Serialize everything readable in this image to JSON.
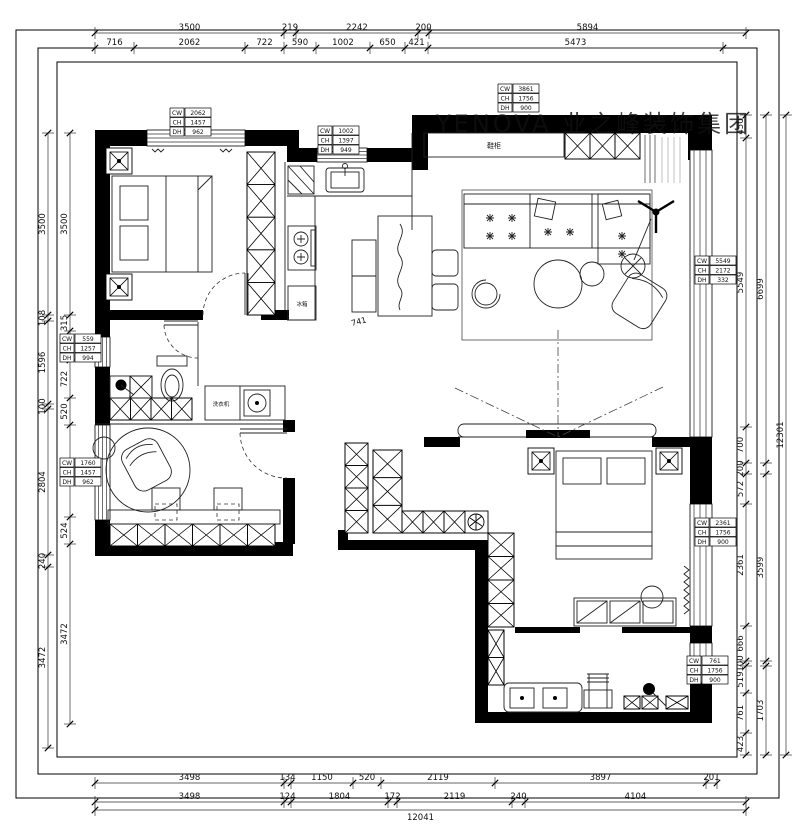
{
  "watermark": "YENOVA 业之峰装饰集团",
  "labels": {
    "entry_cabinet": "鞋柜",
    "washer": "洗衣机",
    "kitchen_appliance": "冰箱",
    "interior_dim": "741"
  },
  "dimensions": {
    "top_outer": [
      "3500",
      "219",
      "2242",
      "200",
      "5894"
    ],
    "top_inner": [
      "716",
      "2062",
      "722",
      "590",
      "1002",
      "650",
      "421",
      "5473"
    ],
    "bottom_inner": [
      "3498",
      "134",
      "1150",
      "520",
      "2119",
      "3897",
      "201"
    ],
    "bottom_outer": [
      "3498",
      "124",
      "1804",
      "172",
      "2119",
      "240",
      "4104"
    ],
    "bottom_total": [
      "12041"
    ],
    "left_outer": [
      "3500",
      "108",
      "1596",
      "100",
      "2804",
      "240",
      "3472"
    ],
    "left_inner": [
      "3500",
      "315",
      "559",
      "722",
      "520",
      "1760",
      "524",
      "3472"
    ],
    "right_inner": [
      "450",
      "5549",
      "700",
      "200",
      "572",
      "2361",
      "666",
      "100",
      "519",
      "761",
      "423"
    ],
    "right_mid": [
      "6699",
      "",
      "3599",
      "",
      "1703"
    ],
    "right_total": [
      "12301"
    ]
  },
  "window_tags": {
    "field_labels": [
      "CW",
      "CH",
      "DH"
    ],
    "tags": [
      {
        "name": "bedroom-window",
        "cw": "2062",
        "ch": "1457",
        "dh": "962"
      },
      {
        "name": "kitchen-window",
        "cw": "1002",
        "ch": "1397",
        "dh": "949"
      },
      {
        "name": "entry-window",
        "cw": "3861",
        "ch": "1756",
        "dh": "900"
      },
      {
        "name": "left-small-window",
        "cw": "559",
        "ch": "1257",
        "dh": "994"
      },
      {
        "name": "study-window",
        "cw": "1760",
        "ch": "1457",
        "dh": "962"
      },
      {
        "name": "living-window",
        "cw": "5549",
        "ch": "2172",
        "dh": "332"
      },
      {
        "name": "master-window",
        "cw": "2361",
        "ch": "1756",
        "dh": "900"
      },
      {
        "name": "master-bath-window",
        "cw": "761",
        "ch": "1756",
        "dh": "900"
      }
    ]
  }
}
